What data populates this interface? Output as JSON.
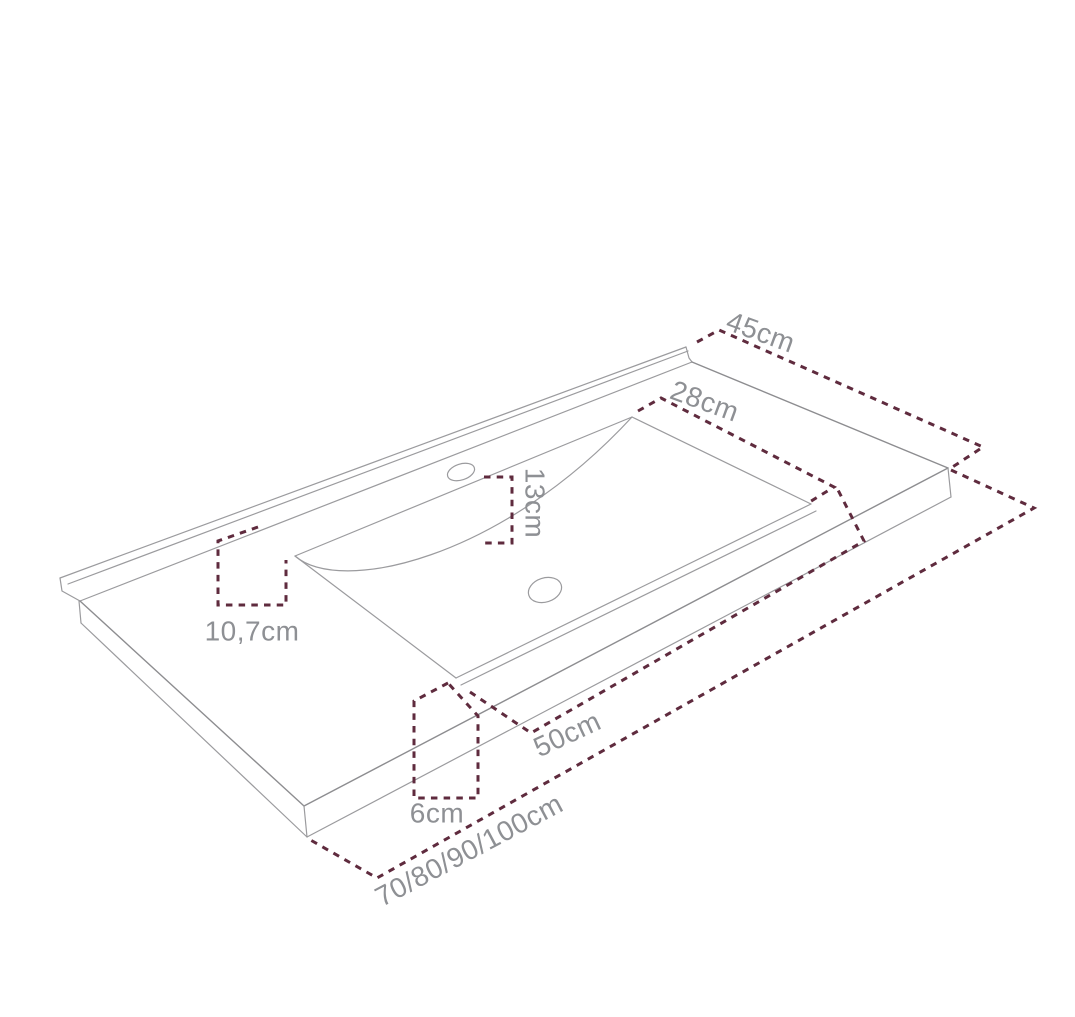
{
  "diagram": {
    "description": "Perspective line drawing of a rectangular vanity washbasin countertop with dashed dimension lines",
    "colors": {
      "background": "#ffffff",
      "outline": "#9b9b9e",
      "dimension": "#5f2b3e",
      "label": "#8e9094"
    },
    "dimensions": [
      {
        "id": "countertop-depth",
        "value": "45cm"
      },
      {
        "id": "basin-rim-depth",
        "value": "28cm"
      },
      {
        "id": "basin-front-offset",
        "value": "13cm"
      },
      {
        "id": "basin-rear-offset",
        "value": "10,7cm"
      },
      {
        "id": "basin-width",
        "value": "50cm"
      },
      {
        "id": "front-edge-height",
        "value": "6cm"
      },
      {
        "id": "countertop-width-options",
        "value": "70/80/90/100cm"
      }
    ]
  }
}
